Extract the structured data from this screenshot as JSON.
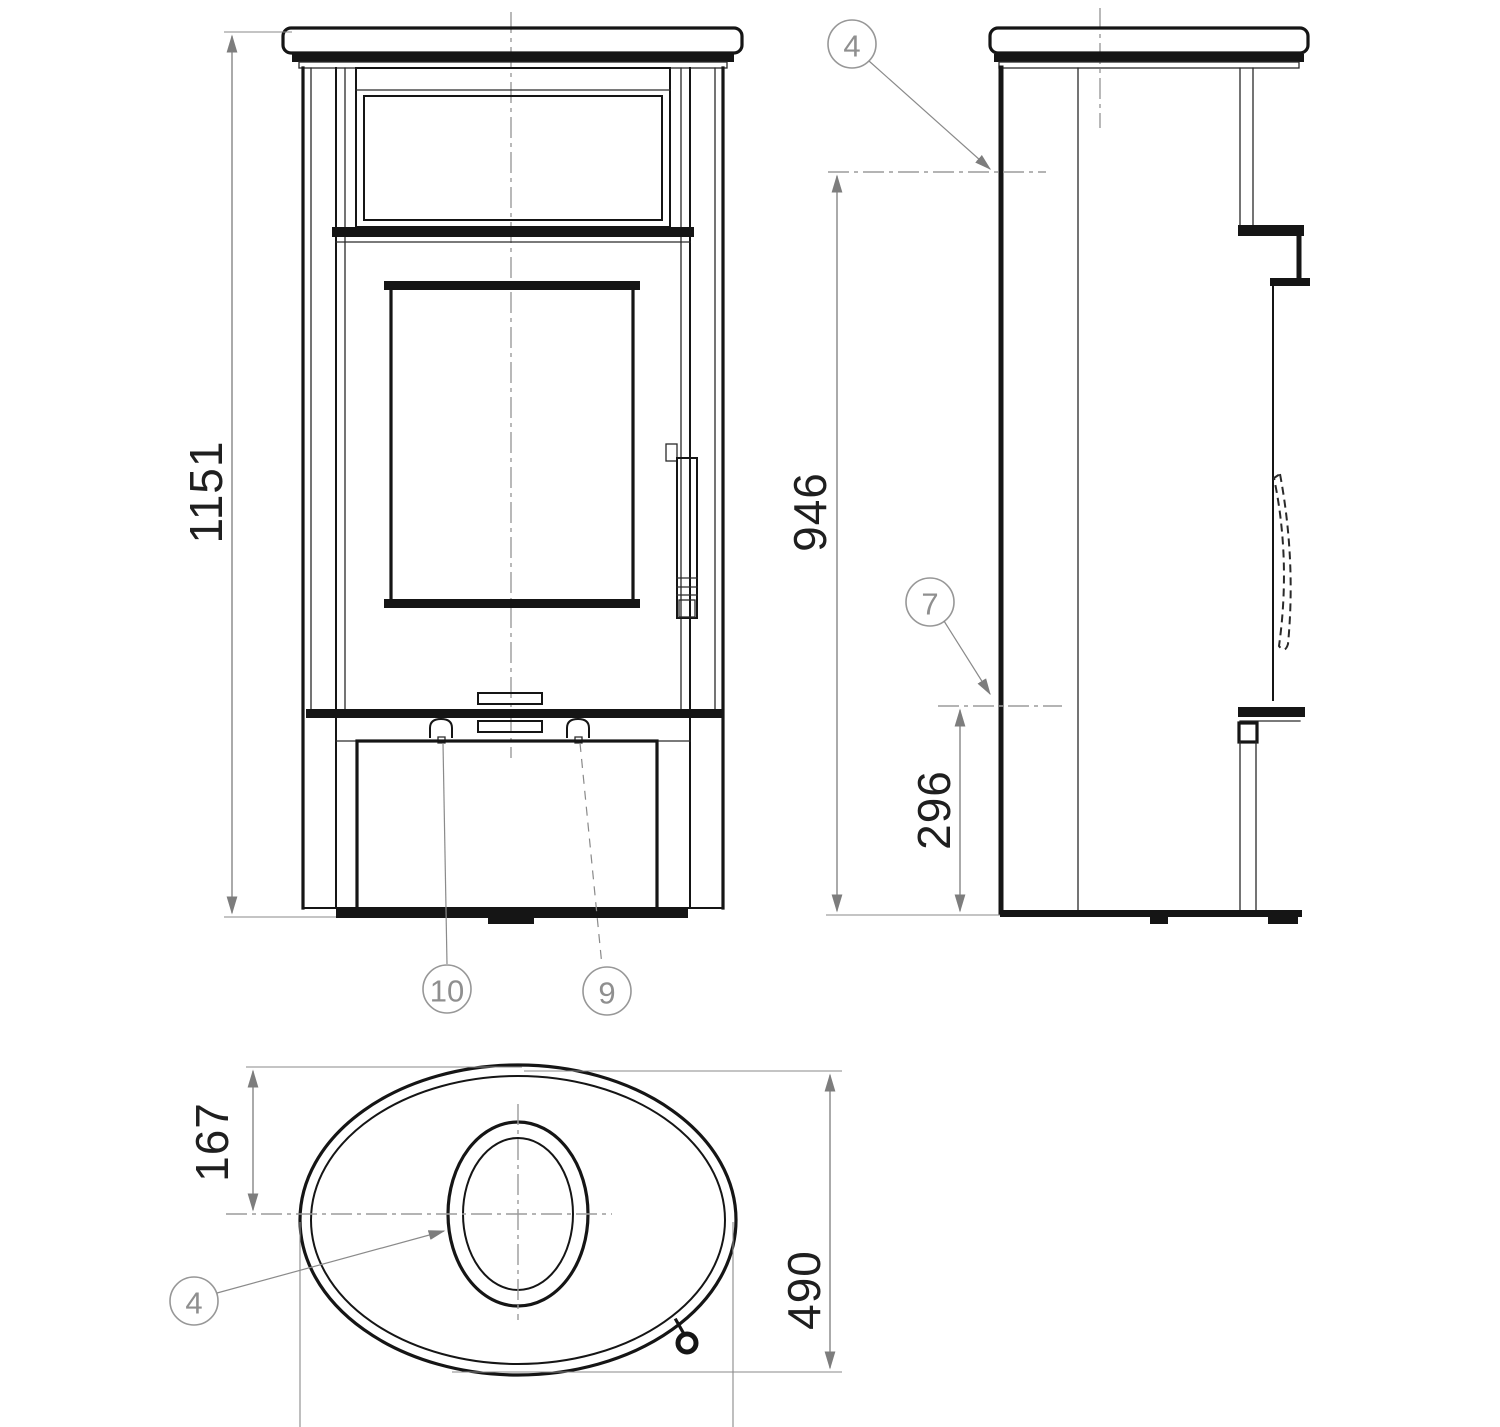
{
  "drawing": {
    "kind": "technical-dimension-drawing",
    "subject": "oval wood-burning stove, three orthographic views",
    "units": "mm"
  },
  "front_view": {
    "height_dim": "1151",
    "callouts": {
      "left_knob": "10",
      "right_knob": "9"
    }
  },
  "side_view": {
    "top_outlet_height_dim": "946",
    "rear_outlet_height_dim": "296",
    "callouts": {
      "top_outlet": "4",
      "rear_outlet": "7"
    }
  },
  "top_view": {
    "flue_offset_dim": "167",
    "depth_dim": "490",
    "callouts": {
      "flue_collar": "4"
    }
  },
  "colors": {
    "background": "#ffffff",
    "part_line": "#151515",
    "dimension_line": "#7d7d7d",
    "centerline": "#9b9b9b",
    "callout": "#979797",
    "dimension_text": "#1f1f1f"
  }
}
